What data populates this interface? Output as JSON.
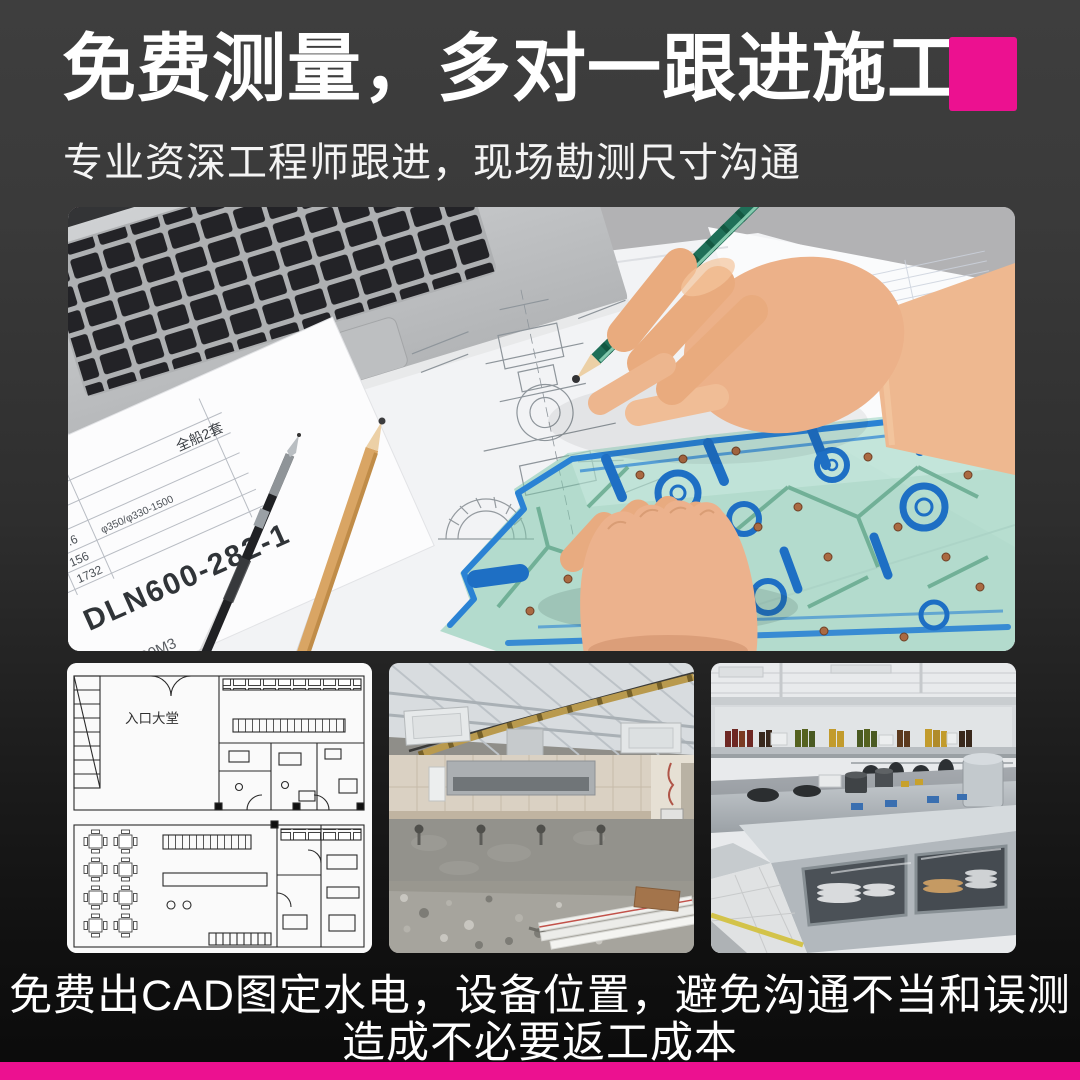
{
  "colors": {
    "accent_pink": "#EC1190",
    "background_top": "#3E3E3E",
    "background_bottom": "#0B0B0B",
    "stencil_blue": "#1E6FC4",
    "stencil_teal": "#80C6AC"
  },
  "header": {
    "title": "免费测量，多对一跟进施工",
    "subtitle": "专业资深工程师跟进，现场勘测尺寸沟通"
  },
  "main_photo": {
    "description": "工程师手持铅笔与绘图模板在图纸上勘测绘图",
    "paper": {
      "sheet_label": "全船2套",
      "row1a": "570",
      "row1b": "570",
      "row2a": "2.4",
      "row2b": "9.6",
      "row2c": "φ350/φ330-1500",
      "row3a": "156",
      "row3b": "156",
      "row4a": "866",
      "row4b": "1732",
      "code": "DLN600-282-1",
      "side_label": "系统",
      "bottom_label": "6000M3"
    }
  },
  "gallery": {
    "floor_plan": {
      "label": "入口大堂"
    }
  },
  "footer": {
    "line1": "免费出CAD图定水电，设备位置，避免沟通不当和误测",
    "line2": "造成不必要返工成本"
  }
}
